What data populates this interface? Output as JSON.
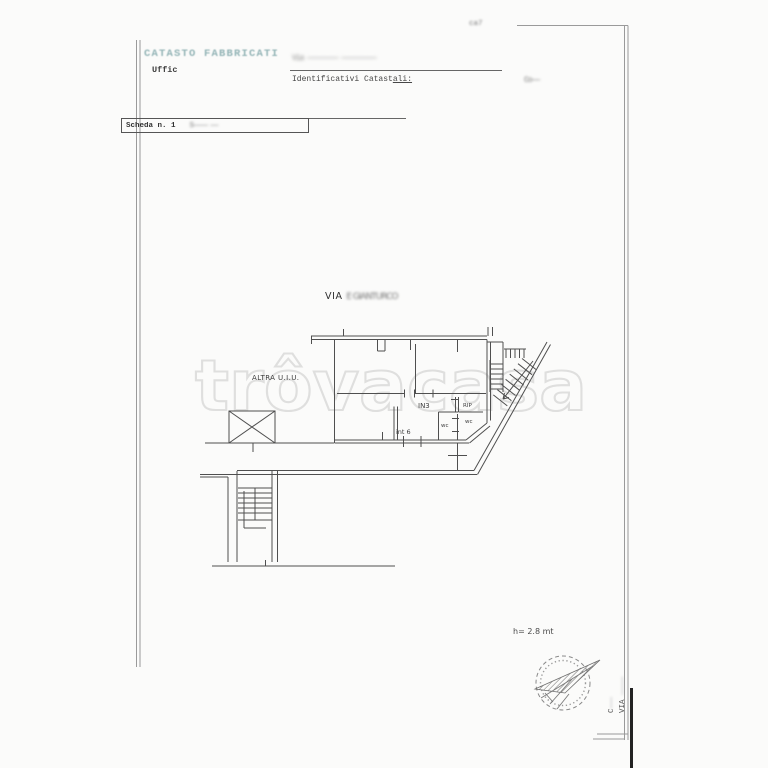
{
  "document": {
    "page_mark": "ca7",
    "registry_title": "CATASTO FABBRICATI",
    "office_label": "Uffic",
    "address_redacted": "Via ———————— —————————",
    "identifiers_label_a": "Identificativi Catast",
    "identifiers_label_b": "ali:",
    "comune_redacted": "Co——",
    "scheda_label": "Scheda n. 1",
    "scheda_redacted": "S———— ——"
  },
  "plan": {
    "street_prefix": "VIA",
    "street_redacted": "E GIANTURCO",
    "altra_uiu_label": "ALTRA U.I.U.",
    "room_in3": "IN3",
    "room_rip": "RIP",
    "room_wc_left": "wc",
    "room_wc_right": "wc",
    "unit_label": "int 6",
    "height_note": "h= 2.8 mt"
  },
  "watermark": "trôvacasa",
  "side_note": {
    "line1_prefix": "C",
    "line1_tail": "———",
    "line2_prefix": "VIA",
    "line2_tail": "—————"
  },
  "colors": {
    "registry_teal": "#93b4b6",
    "ink": "#474747",
    "plan_line": "#4f4f4f",
    "frame_line": "#9a9a9a",
    "watermark_gray": "#dcdcdc"
  }
}
